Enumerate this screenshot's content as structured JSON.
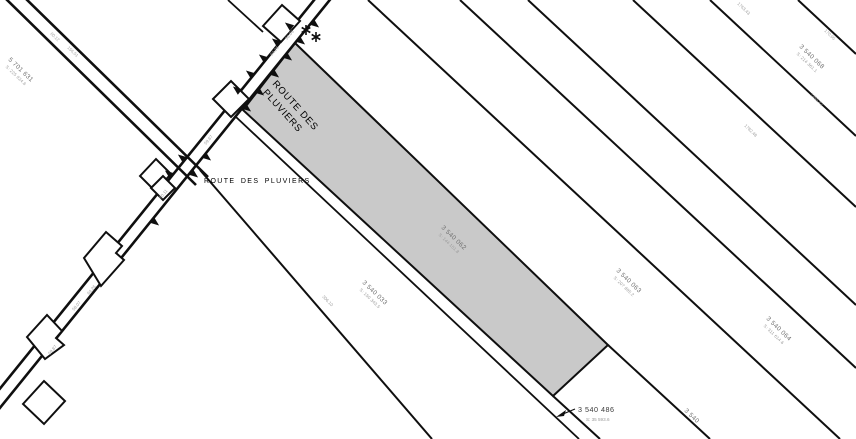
{
  "map": {
    "road_label_rotated": {
      "line1": "ROUTE DES",
      "line2": "PLUVIERS"
    },
    "road_name_horizontal": "ROUTE DES PLUVIERS",
    "colors": {
      "background": "#ffffff",
      "line": "#0f0f0f",
      "highlight_parcel_fill": "#c9c9c9",
      "parcel_label": "#6e6e6e",
      "parcel_area_label": "#999999",
      "measurement_label": "#a0a0a0",
      "road_name": "#3c3c3c"
    },
    "highlight_parcel": {
      "id": "3 540 062",
      "area": "S: 144 151.8",
      "x": 441,
      "y": 228,
      "rot": 44
    },
    "parcels": [
      {
        "id": "5 701 631",
        "area": "S: 225 924.6",
        "x": 8,
        "y": 60,
        "rot": 44
      },
      {
        "id": "3 540 033",
        "area": "S: 150 343.5",
        "x": 362,
        "y": 283,
        "rot": 44
      },
      {
        "id": "3 540 063",
        "area": "S: 207 895.2",
        "x": 616,
        "y": 271,
        "rot": 44
      },
      {
        "id": "3 540 064",
        "area": "S: 311 614.6",
        "x": 766,
        "y": 319,
        "rot": 44
      },
      {
        "id": "3 540 068",
        "area": "S: 214 361.1",
        "x": 799,
        "y": 47,
        "rot": 44
      },
      {
        "id": "3 540",
        "area": "",
        "x": 684,
        "y": 411,
        "rot": 44
      }
    ],
    "callout": {
      "id": "3 540 486",
      "area": "S: 35 593.6",
      "x": 578,
      "y": 412
    },
    "measurements": [
      {
        "x": 50,
        "y": 34,
        "rot": 44,
        "t": "60.12"
      },
      {
        "x": 67,
        "y": 48,
        "rot": 44,
        "t": "156.51"
      },
      {
        "x": 287,
        "y": 40,
        "rot": -50,
        "t": "58.05"
      },
      {
        "x": 272,
        "y": 56,
        "rot": -50,
        "t": "64.26"
      },
      {
        "x": 206,
        "y": 145,
        "rot": -50,
        "t": "59.67"
      },
      {
        "x": 161,
        "y": 199,
        "rot": -50,
        "t": "60.11"
      },
      {
        "x": 89,
        "y": 295,
        "rot": -50,
        "t": "64.26"
      },
      {
        "x": 74,
        "y": 311,
        "rot": -50,
        "t": "58.07"
      },
      {
        "x": 50,
        "y": 355,
        "rot": -50,
        "t": "59.87"
      },
      {
        "x": 322,
        "y": 297,
        "rot": 46,
        "t": "306.10"
      },
      {
        "x": 824,
        "y": 31,
        "rot": 44,
        "t": "170.95"
      },
      {
        "x": 810,
        "y": 95,
        "rot": 44,
        "t": "1485.42"
      },
      {
        "x": 744,
        "y": 126,
        "rot": 44,
        "t": "1782.48"
      },
      {
        "x": 737,
        "y": 4,
        "rot": 44,
        "t": "1763.43"
      }
    ]
  }
}
